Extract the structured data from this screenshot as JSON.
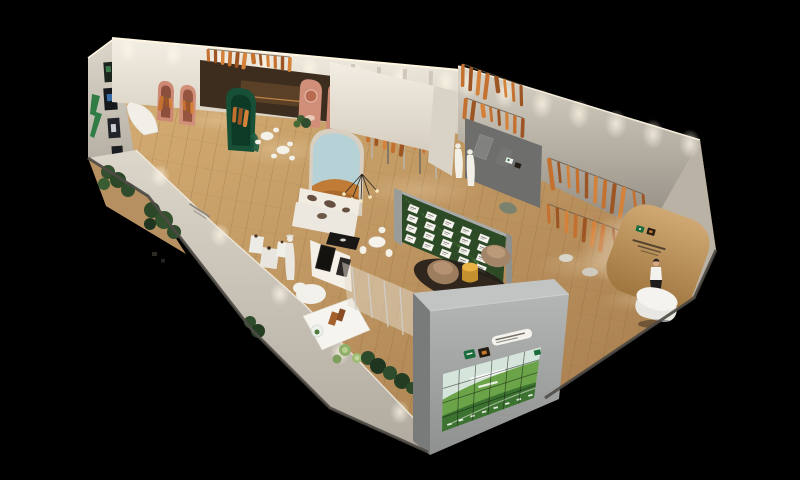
{
  "scene": {
    "description": "Aerial 3D render of a long trade-show exhibition booth: wood plank flooring, white and grey display walls hung with orange cured hams, pink and green arch niches, lounge with landscape mural and cowhide sofa, moss menu wall with white cards, tan armchairs with yellow drum table, grey LED video-wall monolith showing green hills, curved wooden reception wall with hostess, all on a black background",
    "background": "#000000",
    "width": 800,
    "height": 480
  },
  "palette": {
    "floor_light": "#d9b277",
    "floor_dark": "#a2784a",
    "wall_white_hi": "#f3eee3",
    "wall_white_lo": "#d5cec0",
    "wall_grey_hi": "#d9d3c6",
    "wall_grey_lo": "#8f897f",
    "panel_dark": "#6e6e6c",
    "ham_orange": "#c4702f",
    "ham_dark": "#9e5524",
    "ham_light": "#d4823a",
    "arch_pink": "#cd8973",
    "arch_pink_inner": "#8c4f3c",
    "arch_green": "#174f37",
    "arch_green_inner": "#0d3a27",
    "moss_green": "#2d4a27",
    "mural_sky": "#b6d2d6",
    "mural_sand": "#c07c36",
    "sofa_white": "#ece8df",
    "rug_dark": "#241d18",
    "armchair_tan": "#9c7e5e",
    "armchair_tan2": "#a3856a",
    "drum_yellow_top": "#e8b344",
    "drum_yellow_side": "#c3922e",
    "monolith_top": "#c2c4c3",
    "monolith_side": "#787b79",
    "monolith_front_hi": "#b4b6b5",
    "monolith_front_lo": "#8e918f",
    "screen_sky": "#d6e5db",
    "screen_hill": "#6aa348",
    "screen_hill_dark": "#3c7330",
    "logo_green": "#1c6b3c",
    "logo_dark": "#241b12",
    "reception_wood_hi": "#cfa873",
    "reception_wood_lo": "#a0763f",
    "plant_green": "#2f4d2c",
    "sand": "#b69060"
  },
  "video_wall": {
    "rows": 4,
    "cols": 6,
    "quad": [
      [
        443,
        374
      ],
      [
        541,
        347
      ],
      [
        534,
        398
      ],
      [
        442,
        432
      ]
    ],
    "bottom_label_count": 8,
    "bottom_row_from": [
      447,
      424
    ],
    "bottom_row_to": [
      528,
      395
    ]
  },
  "menu_board": {
    "rows": 4,
    "cols": 5,
    "origin": [
      410,
      204
    ],
    "col_step": [
      17.6,
      7.4
    ],
    "row_step": [
      -1,
      10
    ],
    "card_w": 10,
    "card_h": 6.5,
    "angle": 22
  },
  "moss_wall": {
    "quad": [
      [
        402,
        194
      ],
      [
        506,
        237
      ],
      [
        503,
        284
      ],
      [
        402,
        242
      ]
    ],
    "dot_count": 48
  },
  "ham_clusters": [
    {
      "id": "backleft",
      "from": [
        208,
        49
      ],
      "to": [
        290,
        57
      ],
      "count": 12,
      "len": 15
    },
    {
      "id": "rightupper",
      "from": [
        463,
        64
      ],
      "to": [
        521,
        85
      ],
      "count": 8,
      "len": 24
    },
    {
      "id": "rightlower",
      "from": [
        466,
        98
      ],
      "to": [
        523,
        118
      ],
      "count": 8,
      "len": 20
    },
    {
      "id": "rail1",
      "from": [
        549,
        158
      ],
      "to": [
        643,
        194
      ],
      "count": 11,
      "len": 28
    },
    {
      "id": "rail2",
      "from": [
        548,
        204
      ],
      "to": [
        641,
        238
      ],
      "count": 11,
      "len": 24
    },
    {
      "id": "center",
      "from": [
        368,
        120
      ],
      "to": [
        450,
        141
      ],
      "count": 10,
      "len": 24
    },
    {
      "id": "greenarch",
      "from": [
        235,
        107
      ],
      "to": [
        247,
        110
      ],
      "count": 3,
      "len": 15
    },
    {
      "id": "pinkarch1",
      "from": [
        162,
        96
      ],
      "to": [
        170,
        98
      ],
      "count": 3,
      "len": 13
    },
    {
      "id": "pinkarch2",
      "from": [
        184,
        100
      ],
      "to": [
        192,
        102
      ],
      "count": 3,
      "len": 13
    }
  ],
  "wall_glows": [
    {
      "id": "a",
      "from": [
        128,
        44
      ],
      "to": [
        446,
        76
      ],
      "count": 8,
      "rx": 9,
      "ry": 13
    },
    {
      "id": "b",
      "from": [
        468,
        78
      ],
      "to": [
        690,
        138
      ],
      "count": 7,
      "rx": 11,
      "ry": 15
    },
    {
      "id": "c",
      "from": [
        160,
        170
      ],
      "to": [
        400,
        406
      ],
      "count": 5,
      "rx": 10,
      "ry": 12
    }
  ],
  "floor_pools": [
    [
      280,
      150,
      55,
      16
    ],
    [
      420,
      190,
      60,
      18
    ],
    [
      590,
      265,
      55,
      16
    ],
    [
      220,
      120,
      40,
      12
    ],
    [
      500,
      160,
      45,
      14
    ],
    [
      640,
      300,
      40,
      12
    ]
  ]
}
